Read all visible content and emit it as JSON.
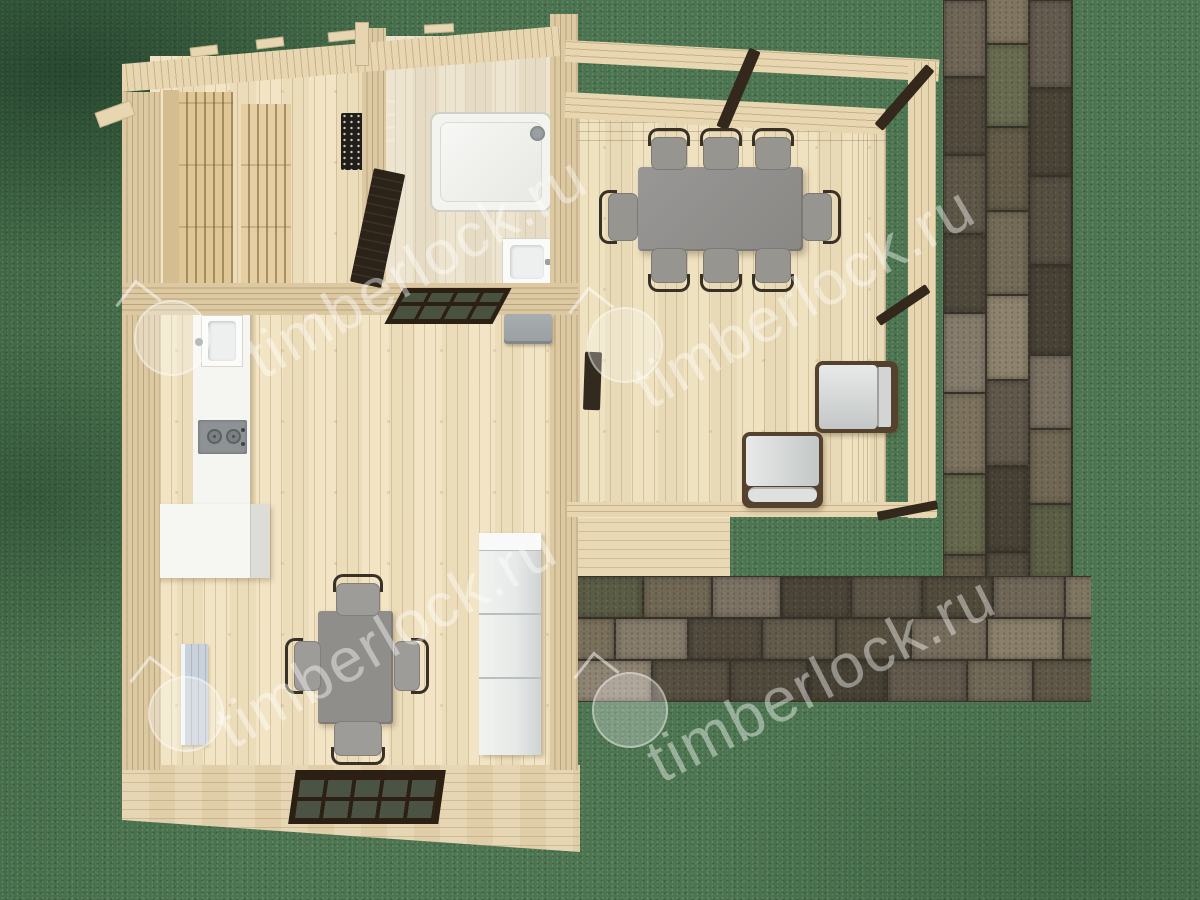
{
  "watermark": {
    "text": "timberlock.ru",
    "logo": "house-in-circle",
    "text_instances": 4,
    "logo_instances": 4
  },
  "scene": {
    "view": "top-down-3d-floor-plan",
    "rooms": [
      "sauna",
      "shower-room",
      "kitchen-living-room",
      "covered-terrace",
      "front-porch"
    ],
    "furniture_counts": {
      "terrace_dining_chairs": 8,
      "living_dining_chairs": 4,
      "lounge_chairs": 2,
      "sauna_benches": 2
    }
  },
  "colors": {
    "grass": "#4c7450",
    "stone_gap": "#38332a",
    "stone_palette": [
      "#6a6153",
      "#564f3f",
      "#7b7263",
      "#4e483a",
      "#635c4b",
      "#716855",
      "#595244",
      "#786f5d",
      "#5c5e46",
      "#4a4438"
    ],
    "wood_floor": "#f1e3c1",
    "wood_floor_line": "rgba(158,124,78,0.30)",
    "wood_floor_pale": "#ece3cd",
    "wood_wall": "#dcc9a2",
    "wood_wall_line": "rgba(120,95,60,0.35)",
    "wood_roof": "#e7d6b0",
    "wood_deck": "#eee0bd",
    "wood_porch": "#e5d4af",
    "wood_step": "#e9d8b4",
    "bench": "#dfc795",
    "bench_side": "#d5bd92",
    "bench_gap": "rgba(110,80,45,0.5)",
    "stove": "#211d18",
    "door_dark": "#2b2218",
    "brace": "#33281b",
    "table_gray": "#908e8b",
    "seat_gray": "#9e9c98",
    "chair_frame": "#3a3126",
    "lounge_frame": "#55422e",
    "lounge_cushion_hi": "#e8eae9",
    "lounge_cushion_lo": "#c3c7c6",
    "counter_white": "#f5f5f2",
    "cooktop": "#8e9294",
    "burner": "#5b6062",
    "cabinet_hi": "#f1f3f1",
    "cabinet_lo": "#cfd4d2",
    "cabinet_seam": "#b9bfbc",
    "radiator": "#c9d2da",
    "window_frame": "#2c2014",
    "window_pane": "#4b5444",
    "shower_white": "#f3f3f0",
    "fixture_gray": "#9aa0a2",
    "watermark_white": "rgba(255,255,255,0.42)"
  }
}
